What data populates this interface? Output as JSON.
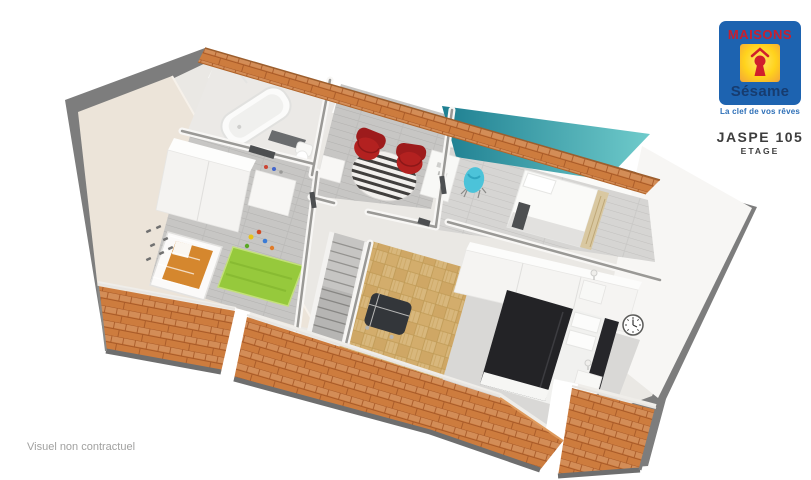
{
  "branding": {
    "logo": {
      "brand_top": "MAISONS",
      "brand_bottom": "Sésame",
      "tagline": "La clef de vos rêves",
      "colors": {
        "box": "#1d63b0",
        "brand_top": "#c8202e",
        "square": "#ffd21c",
        "square_glow": "#f2a33a",
        "keyhole": "#d01f2c",
        "brand_bottom": "#173c6f",
        "tagline": "#2d6fb7"
      }
    },
    "plan_name": "JASPE 105",
    "plan_level": "ETAGE"
  },
  "footer": {
    "disclaimer": "Visuel non contractuel"
  },
  "text_colors": {
    "plan": "#3d3d3d",
    "disclaimer": "#a1a1a0"
  },
  "floorplan": {
    "type": "3d-isometric-floor-plan",
    "rooms": [
      "bathroom",
      "landing",
      "bedroom-teal",
      "nursery",
      "master-bedroom",
      "staircase"
    ],
    "colors": {
      "roof_tile": "#cd7c3e",
      "roof_tile_line": "#a85a28",
      "wall_cut": "#7d7d7d",
      "wall_face": "#f7f6f4",
      "cream_wall": "#ece4d9",
      "floor_wood": "#c7c6c4",
      "floor_wood_light": "#d6d5d3",
      "floor_parquet": "#d8b77c",
      "accent_teal_dark": "#1e7f91",
      "accent_teal_light": "#6fcbcb",
      "rug_green": "#96c93c",
      "armchair_red": "#b32120",
      "chair_turquoise": "#4cc3d9",
      "bed_dark": "#232326",
      "crib_orange": "#d5872e",
      "rug_gray": "#d9d8d6",
      "stairs_gray": "#c6c5c3"
    }
  }
}
